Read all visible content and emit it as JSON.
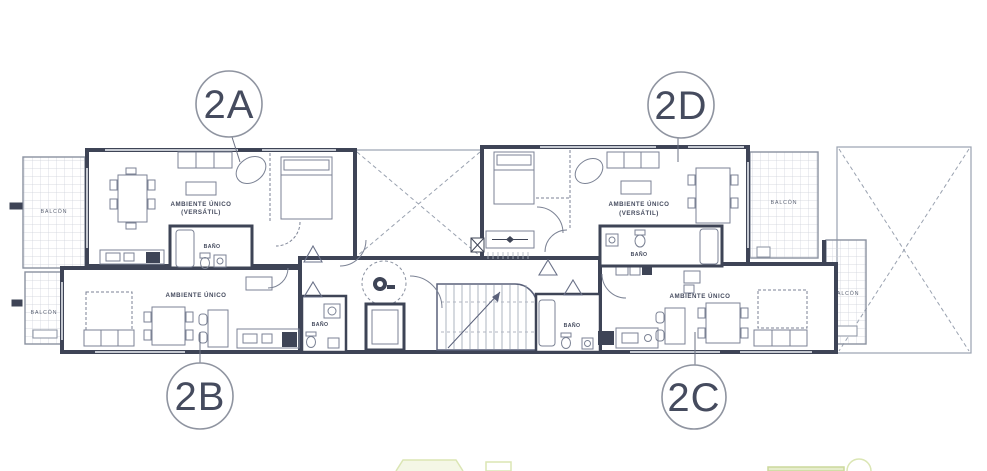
{
  "floor_plan": {
    "unit_badges": [
      {
        "label": "2A"
      },
      {
        "label": "2B"
      },
      {
        "label": "2C"
      },
      {
        "label": "2D"
      }
    ],
    "room_labels": {
      "main_room": "AMBIENTE ÚNICO",
      "versatile": "(VERSÁTIL)",
      "bathroom": "BAÑO",
      "balcony": "BALCÓN"
    },
    "colors": {
      "badge_text": "#cbd88c",
      "badge_ring": "#8f94a0",
      "wall": "#3e4456",
      "thin_line": "#7b8294",
      "grid_line": "#ccd0d8",
      "accent_green_light": "#dbe6b4"
    }
  }
}
